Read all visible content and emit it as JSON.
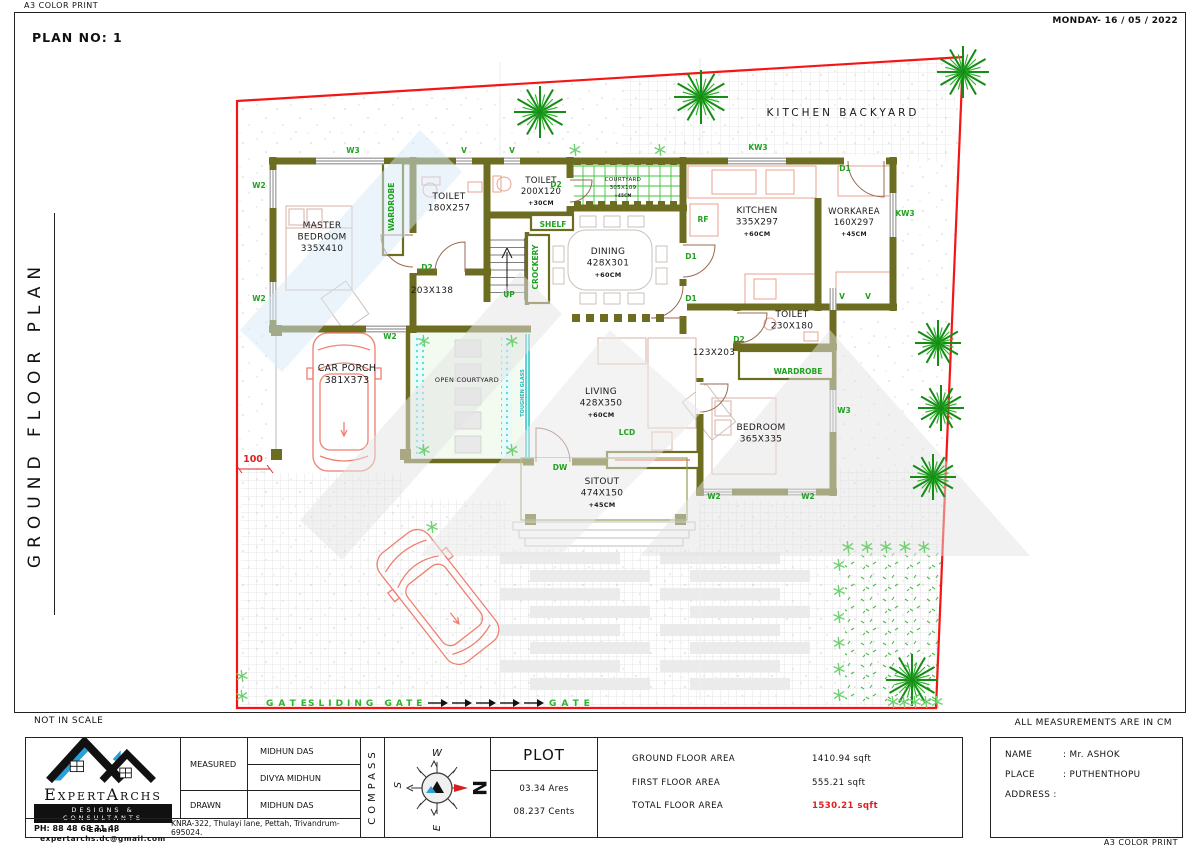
{
  "page": {
    "top_left_label": "A3 COLOR PRINT",
    "date": "MONDAY- 16 / 05 / 2022",
    "plan_no": "PLAN NO: 1",
    "side_title": "GROUND FLOOR PLAN",
    "not_in_scale": "NOT IN SCALE",
    "measurements_note": "ALL MEASUREMENTS ARE IN CM",
    "bottom_right_label": "A3 COLOR PRINT"
  },
  "colors": {
    "wall": "#6d6d21",
    "boundary": "#f51515",
    "tag_green": "#1fa21f",
    "gate_green": "#2ab52a",
    "cyan": "#1fb9b9",
    "car": "#ef8070",
    "fixture": "#e9a18e",
    "furniture": "#d8b2a4",
    "brand_blue": "#2a9fd8",
    "total_red": "#e02020"
  },
  "plan": {
    "rooms": [
      {
        "x": 322,
        "y": 228,
        "fs": 9,
        "lines": [
          "MASTER",
          "BEDROOM",
          "335X410"
        ]
      },
      {
        "x": 449,
        "y": 199,
        "fs": 9,
        "lines": [
          "TOILET",
          "180X257"
        ]
      },
      {
        "x": 541,
        "y": 183,
        "fs": 8.5,
        "lines": [
          "TOILET",
          "200X120",
          "+30CM"
        ]
      },
      {
        "x": 623,
        "y": 181,
        "fs": 5.5,
        "lines": [
          "COURTYARD",
          "305X109",
          "+45CM"
        ]
      },
      {
        "x": 757,
        "y": 213,
        "fs": 9,
        "lines": [
          "KITCHEN",
          "335X297",
          "+60CM"
        ]
      },
      {
        "x": 854,
        "y": 214,
        "fs": 8.5,
        "lines": [
          "WORKAREA",
          "160X297",
          "+45CM"
        ]
      },
      {
        "x": 608,
        "y": 254,
        "fs": 9,
        "lines": [
          "DINING",
          "428X301",
          "+60CM"
        ]
      },
      {
        "x": 792,
        "y": 317,
        "fs": 9,
        "lines": [
          "TOILET",
          "230X180"
        ]
      },
      {
        "x": 761,
        "y": 430,
        "fs": 9,
        "lines": [
          "BEDROOM",
          "365X335"
        ]
      },
      {
        "x": 601,
        "y": 394,
        "fs": 9,
        "lines": [
          "LIVING",
          "428X350",
          "+60CM"
        ]
      },
      {
        "x": 467,
        "y": 382,
        "fs": 6.5,
        "lines": [
          "OPEN  COURTYARD"
        ]
      },
      {
        "x": 347,
        "y": 371,
        "fs": 9.5,
        "lines": [
          "CAR  PORCH",
          "381X373"
        ]
      },
      {
        "x": 602,
        "y": 484,
        "fs": 9,
        "lines": [
          "SITOUT",
          "474X150",
          "+45CM"
        ]
      },
      {
        "x": 432,
        "y": 293,
        "fs": 9,
        "lines": [
          "203X138"
        ]
      },
      {
        "x": 714,
        "y": 355,
        "fs": 9,
        "lines": [
          "123X203"
        ]
      },
      {
        "x": 843,
        "y": 116,
        "fs": 10.5,
        "sp": 3,
        "lines": [
          "KITCHEN  BACKYARD"
        ]
      }
    ],
    "tags": [
      {
        "t": "W3",
        "x": 353,
        "y": 153
      },
      {
        "t": "V",
        "x": 464,
        "y": 153
      },
      {
        "t": "V",
        "x": 512,
        "y": 153
      },
      {
        "t": "D2",
        "x": 556,
        "y": 187
      },
      {
        "t": "KW3",
        "x": 758,
        "y": 150
      },
      {
        "t": "D1",
        "x": 845,
        "y": 171
      },
      {
        "t": "KW3",
        "x": 905,
        "y": 216
      },
      {
        "t": "W2",
        "x": 259,
        "y": 188
      },
      {
        "t": "W2",
        "x": 259,
        "y": 301
      },
      {
        "t": "RF",
        "x": 703,
        "y": 222
      },
      {
        "t": "D1",
        "x": 691,
        "y": 259
      },
      {
        "t": "D1",
        "x": 691,
        "y": 301
      },
      {
        "t": "D2",
        "x": 427,
        "y": 270
      },
      {
        "t": "W2",
        "x": 390,
        "y": 339
      },
      {
        "t": "V",
        "x": 842,
        "y": 299
      },
      {
        "t": "D2",
        "x": 739,
        "y": 342
      },
      {
        "t": "SHELF",
        "x": 553,
        "y": 227
      },
      {
        "t": "UP",
        "x": 509,
        "y": 297
      },
      {
        "t": "DW",
        "x": 560,
        "y": 470
      },
      {
        "t": "LCD",
        "x": 627,
        "y": 435
      },
      {
        "t": "W3",
        "x": 844,
        "y": 413
      },
      {
        "t": "W2",
        "x": 714,
        "y": 499
      },
      {
        "t": "W2",
        "x": 808,
        "y": 499
      },
      {
        "t": "WARDROBE",
        "x": 394,
        "y": 207,
        "rot": -90
      },
      {
        "t": "CROCKERY",
        "x": 538,
        "y": 267,
        "rot": -90
      },
      {
        "t": "WARDROBE",
        "x": 798,
        "y": 374
      },
      {
        "t": "TOUGHEN GLASS",
        "x": 524,
        "y": 393,
        "rot": -90,
        "c": "#1fb9b9",
        "fs": 5
      },
      {
        "t": "100",
        "x": 253,
        "y": 462,
        "c": "#e02020",
        "fs": 9.5
      },
      {
        "t": "V",
        "x": 868,
        "y": 299,
        "c": "#1fa21f"
      }
    ],
    "gate": {
      "left": "GATE",
      "sliding": "SLIDING GATE",
      "right": "GATE",
      "arrow_x": [
        428,
        452,
        476,
        500,
        524
      ],
      "y": 706
    },
    "windows": [
      [
        316,
        157.5,
        68,
        7
      ],
      [
        456,
        157.5,
        16,
        7
      ],
      [
        504,
        157.5,
        16,
        7
      ],
      [
        728,
        157.5,
        58,
        7
      ],
      [
        269.5,
        170,
        7,
        38
      ],
      [
        269.5,
        282,
        7,
        38
      ],
      [
        366,
        325.5,
        40,
        7
      ],
      [
        889.5,
        193,
        7,
        44
      ],
      [
        829.5,
        390,
        7,
        42
      ],
      [
        829.5,
        288,
        7,
        22
      ],
      [
        704,
        488.5,
        28,
        7
      ],
      [
        788,
        488.5,
        28,
        7
      ]
    ],
    "trees": [
      [
        540,
        112,
        26
      ],
      [
        701,
        97,
        27
      ],
      [
        963,
        72,
        26
      ],
      [
        938,
        343,
        23
      ],
      [
        941,
        408,
        23
      ],
      [
        933,
        477,
        23
      ],
      [
        912,
        680,
        26
      ]
    ],
    "shrubs": [
      [
        575,
        150
      ],
      [
        660,
        150
      ],
      [
        424,
        341
      ],
      [
        512,
        341
      ],
      [
        424,
        450
      ],
      [
        512,
        450
      ],
      [
        432,
        527
      ],
      [
        242,
        676
      ],
      [
        242,
        696
      ],
      [
        848,
        547
      ],
      [
        867,
        547
      ],
      [
        886,
        547
      ],
      [
        905,
        547
      ],
      [
        924,
        547
      ],
      [
        839,
        565
      ],
      [
        839,
        591
      ],
      [
        839,
        617
      ],
      [
        839,
        643
      ],
      [
        839,
        669
      ],
      [
        839,
        695
      ],
      [
        893,
        702
      ],
      [
        904,
        702
      ],
      [
        915,
        702
      ],
      [
        926,
        702
      ],
      [
        937,
        702
      ]
    ]
  },
  "titleblock": {
    "brand": {
      "name": "ExpertArchs",
      "tagline": "DESIGNS & CONSULTANTS",
      "email": "Email: expertarchs.dc@gmail.com",
      "phone": "PH: 88 48 68 31 48",
      "address": "KNRA-322, Thulayi lane, Pettah, Trivandrum-695024."
    },
    "table": {
      "measured_label": "MEASURED",
      "drawn_label": "DRAWN",
      "measured_by": "MIDHUN DAS",
      "measured_by2": "DIVYA MIDHUN",
      "drawn_by": "MIDHUN DAS"
    },
    "compass_label": "COMPASS",
    "compass": {
      "n": "N",
      "s": "S",
      "e": "E",
      "w": "W"
    },
    "plot": {
      "title": "PLOT",
      "ares": "03.34 Ares",
      "cents": "08.237 Cents"
    },
    "areas": [
      {
        "label": "GROUND FLOOR AREA",
        "value": "1410.94 sqft"
      },
      {
        "label": "FIRST FLOOR AREA",
        "value": "555.21 sqft"
      },
      {
        "label": "TOTAL FLOOR AREA",
        "value": "1530.21 sqft"
      }
    ],
    "client": {
      "name_label": "NAME",
      "name_value": ":  Mr. ASHOK",
      "place_label": "PLACE",
      "place_value": ":  PUTHENTHOPU",
      "address_label": "ADDRESS :",
      "address_value": ""
    }
  }
}
